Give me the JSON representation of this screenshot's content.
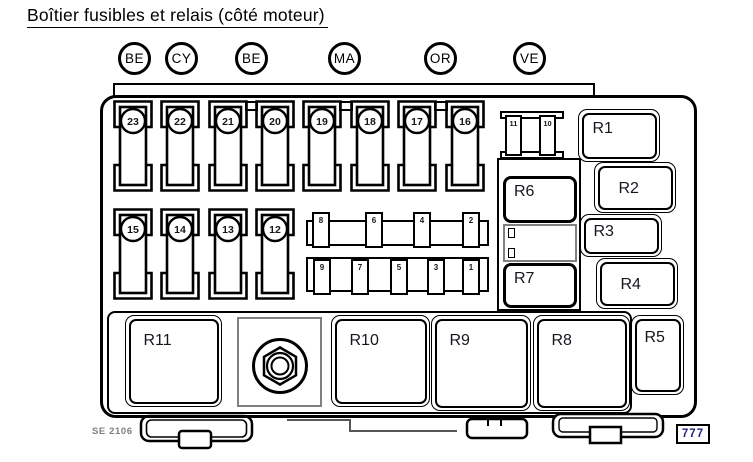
{
  "title": "Boîtier fusibles et relais (côté moteur)",
  "color_codes": [
    "BE",
    "CY",
    "BE",
    "MA",
    "OR",
    "VE"
  ],
  "fuses": {
    "top_row": [
      "23",
      "22",
      "21",
      "20",
      "19",
      "18",
      "17",
      "16"
    ],
    "second_row": [
      "15",
      "14",
      "13",
      "12"
    ],
    "maxi_pair": [
      "11",
      "10"
    ],
    "mini_top_row": [
      "8",
      "6",
      "4",
      "2"
    ],
    "mini_bottom_row": [
      "9",
      "7",
      "5",
      "3",
      "1"
    ]
  },
  "relays": {
    "r1": "R1",
    "r2": "R2",
    "r3": "R3",
    "r4": "R4",
    "r5": "R5",
    "r6": "R6",
    "r7": "R7",
    "r8": "R8",
    "r9": "R9",
    "r10": "R10",
    "r11": "R11"
  },
  "footer": {
    "drawing_code": "SE 2106",
    "page_number": "777"
  },
  "colors": {
    "line": "#000000",
    "label_text": "#16161e",
    "page_number_text": "#23237d",
    "drawing_code_text": "#7f7f7f",
    "background": "#ffffff"
  }
}
